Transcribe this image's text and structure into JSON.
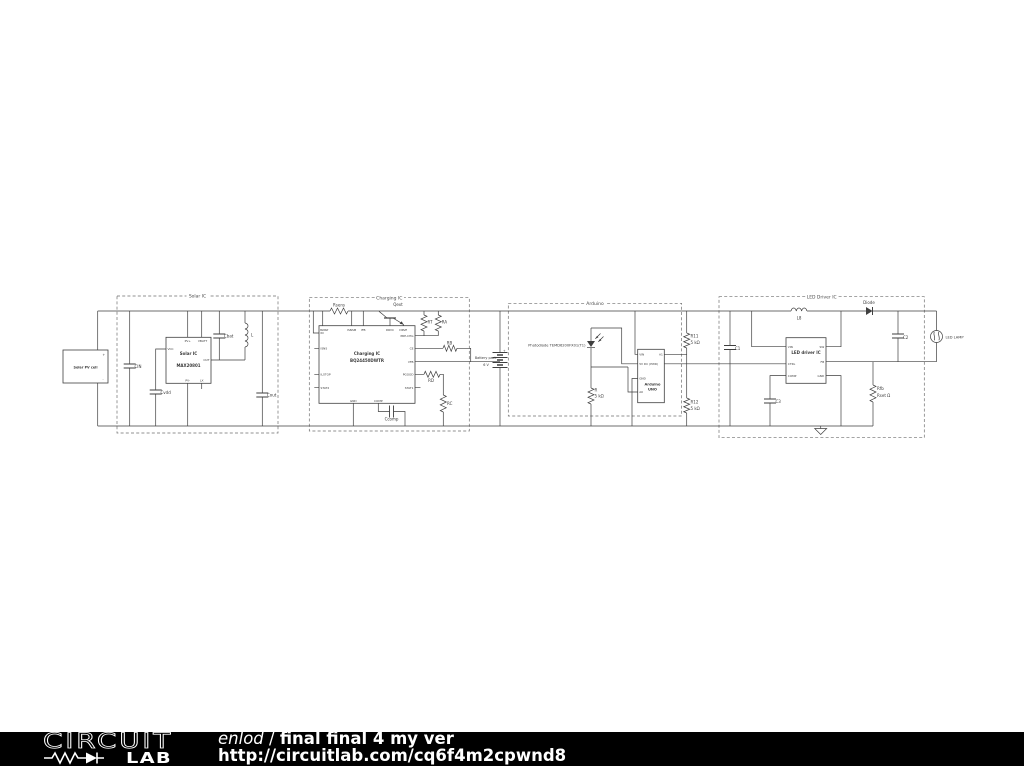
{
  "schematic": {
    "solar": {
      "section_title": "Solar IC",
      "pv_cell_label": "Solar PV cell",
      "pv_plus": "+",
      "pv_minus": "-",
      "cin": "CIN",
      "cvdd": "Cvdd",
      "cbat": "Cbat",
      "inductor": "L",
      "cout": "Cout",
      "ic_name": "Solar IC",
      "ic_part": "MAX20801",
      "pins": {
        "pvp": "PV+",
        "vbatt": "VBATT",
        "vcc": "VCC",
        "out": "OUT",
        "pvm": "PV-",
        "lx": "LX"
      }
    },
    "charging": {
      "section_title": "Charging IC",
      "rsens": "Rsens",
      "qext": "Qext",
      "ic_name": "Charging IC",
      "ic_part": "BQ24450DWTR",
      "pins_top": [
        "ISNSP",
        "ISNSM",
        "IFB",
        "DRVC",
        "DRVE"
      ],
      "pins_left": [
        "IN",
        "ISNS",
        "ILSTOP",
        "STAT2"
      ],
      "pins_right": [
        "PRE-CHG",
        "CE",
        "VFB",
        "PGOOD",
        "STAT1"
      ],
      "pins_bottom": [
        "GND",
        "COMP"
      ],
      "rt": "RT",
      "ra": "RA",
      "rb": "RB",
      "rd": "RD",
      "rc": "RC",
      "ccomp": "Ccomp",
      "battery_label": "Battery pack",
      "battery_voltage": "6 V",
      "battery_plus": "+"
    },
    "arduino": {
      "section_title": "Arduino",
      "photodiode_label": "Photodiode TEMD6200FX01(T1)",
      "board_name1": "Arduino",
      "board_name2": "UNO",
      "pins_left": [
        "VIN",
        "5V  DC (PWR)",
        "GND",
        "A0"
      ],
      "pins_right": [
        "A1"
      ],
      "r_name": "R",
      "r_value": "5 kΩ",
      "r11_name": "R11",
      "r11_value": "5 kΩ",
      "r12_name": "R12",
      "r12_value": "5 kΩ"
    },
    "led": {
      "section_title": "LED Driver IC",
      "c1": "C1",
      "inductor": "L8",
      "diode": "Diode",
      "c2": "C2",
      "c3": "C3",
      "ic_name": "LED driver IC",
      "pins_left": [
        "VIN",
        "CTRL",
        "COMP"
      ],
      "pins_right": [
        "SW",
        "FB",
        "GND"
      ],
      "rfb_name": "Rfb",
      "rfb_value": "Rset Ω",
      "lamp_label": "LED LAMP"
    }
  },
  "footer": {
    "logo_word": "CIRCUIT",
    "logo_lab": "LAB",
    "author": "enlod",
    "separator": " / ",
    "title": "final final 4 my ver",
    "url": "http://circuitlab.com/cq6f4m2cpwnd8"
  }
}
